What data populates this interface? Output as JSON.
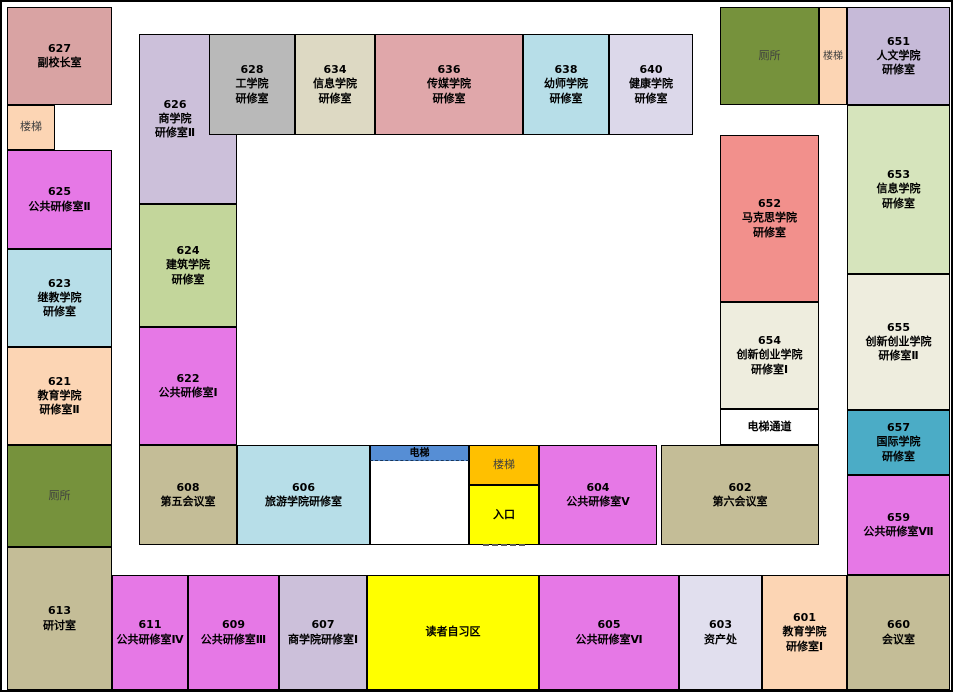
{
  "canvas": {
    "width": 953,
    "height": 692,
    "background": "#ffffff",
    "border_color": "#000000"
  },
  "plan": {
    "rooms": [
      {
        "name": "room-627",
        "lines": [
          "627",
          "副校长室"
        ],
        "bg": "#d9a3a3",
        "x": 5,
        "y": 5,
        "w": 105,
        "h": 98
      },
      {
        "name": "stairs-top-left",
        "lines": [
          "楼梯"
        ],
        "bg": "#fcd5b4",
        "x": 5,
        "y": 103,
        "w": 48,
        "h": 45,
        "muted": true
      },
      {
        "name": "room-625",
        "lines": [
          "625",
          "公共研修室Ⅱ"
        ],
        "bg": "#e678e6",
        "x": 5,
        "y": 148,
        "w": 105,
        "h": 99
      },
      {
        "name": "room-623",
        "lines": [
          "623",
          "继教学院",
          "研修室"
        ],
        "bg": "#b7dee8",
        "x": 5,
        "y": 247,
        "w": 105,
        "h": 98
      },
      {
        "name": "room-621",
        "lines": [
          "621",
          "教育学院",
          "研修室Ⅱ"
        ],
        "bg": "#fcd5b4",
        "x": 5,
        "y": 345,
        "w": 105,
        "h": 98
      },
      {
        "name": "toilet-left",
        "lines": [
          "厕所"
        ],
        "bg": "#76923c",
        "x": 5,
        "y": 443,
        "w": 105,
        "h": 102,
        "muted": true
      },
      {
        "name": "room-613",
        "lines": [
          "613",
          "研讨室"
        ],
        "bg": "#c4bd97",
        "x": 5,
        "y": 545,
        "w": 105,
        "h": 143
      },
      {
        "name": "room-611",
        "lines": [
          "611",
          "公共研修室Ⅳ"
        ],
        "bg": "#e678e6",
        "x": 110,
        "y": 573,
        "w": 76,
        "h": 115
      },
      {
        "name": "room-609",
        "lines": [
          "609",
          "公共研修室Ⅲ"
        ],
        "bg": "#e678e6",
        "x": 186,
        "y": 573,
        "w": 91,
        "h": 115
      },
      {
        "name": "room-607",
        "lines": [
          "607",
          "商学院研修室Ⅰ"
        ],
        "bg": "#ccc0da",
        "x": 277,
        "y": 573,
        "w": 88,
        "h": 115
      },
      {
        "name": "reading-area",
        "lines": [
          "读者自习区"
        ],
        "bg": "#ffff00",
        "x": 365,
        "y": 573,
        "w": 172,
        "h": 115
      },
      {
        "name": "room-605",
        "lines": [
          "605",
          "公共研修室Ⅵ"
        ],
        "bg": "#e678e6",
        "x": 537,
        "y": 573,
        "w": 140,
        "h": 115
      },
      {
        "name": "room-603",
        "lines": [
          "603",
          "资产处"
        ],
        "bg": "#e1dfee",
        "x": 677,
        "y": 573,
        "w": 83,
        "h": 115
      },
      {
        "name": "room-601",
        "lines": [
          "601",
          "教育学院",
          "研修室Ⅰ"
        ],
        "bg": "#fcd5b4",
        "x": 760,
        "y": 573,
        "w": 85,
        "h": 115
      },
      {
        "name": "room-660",
        "lines": [
          "660",
          "会议室"
        ],
        "bg": "#c4bd97",
        "x": 845,
        "y": 573,
        "w": 103,
        "h": 115
      },
      {
        "name": "toilet-top-right",
        "lines": [
          "厕所"
        ],
        "bg": "#76923c",
        "x": 718,
        "y": 5,
        "w": 99,
        "h": 98,
        "muted": true
      },
      {
        "name": "stairs-top-right",
        "lines": [
          "楼梯"
        ],
        "bg": "#fcd5b4",
        "x": 817,
        "y": 5,
        "w": 28,
        "h": 98,
        "muted": true,
        "font": 10
      },
      {
        "name": "room-651",
        "lines": [
          "651",
          "人文学院",
          "研修室"
        ],
        "bg": "#c6bad8",
        "x": 845,
        "y": 5,
        "w": 103,
        "h": 98
      },
      {
        "name": "room-653",
        "lines": [
          "653",
          "信息学院",
          "研修室"
        ],
        "bg": "#d6e4bc",
        "x": 845,
        "y": 103,
        "w": 103,
        "h": 169
      },
      {
        "name": "room-655",
        "lines": [
          "655",
          "创新创业学院",
          "研修室Ⅱ"
        ],
        "bg": "#eeedde",
        "x": 845,
        "y": 272,
        "w": 103,
        "h": 136
      },
      {
        "name": "room-657",
        "lines": [
          "657",
          "国际学院",
          "研修室"
        ],
        "bg": "#4bacc6",
        "x": 845,
        "y": 408,
        "w": 103,
        "h": 65
      },
      {
        "name": "room-659",
        "lines": [
          "659",
          "公共研修室Ⅶ"
        ],
        "bg": "#e678e6",
        "x": 845,
        "y": 473,
        "w": 103,
        "h": 100
      },
      {
        "name": "room-652",
        "lines": [
          "652",
          "马克思学院",
          "研修室"
        ],
        "bg": "#f2908c",
        "x": 718,
        "y": 133,
        "w": 99,
        "h": 167
      },
      {
        "name": "room-654",
        "lines": [
          "654",
          "创新创业学院",
          "研修室Ⅰ"
        ],
        "bg": "#eeedde",
        "x": 718,
        "y": 300,
        "w": 99,
        "h": 107
      },
      {
        "name": "elevator-passage",
        "lines": [
          "电梯通道"
        ],
        "bg": "#ffffff",
        "x": 718,
        "y": 407,
        "w": 99,
        "h": 36
      },
      {
        "name": "room-626",
        "lines": [
          "626",
          "商学院",
          "研修室Ⅱ"
        ],
        "bg": "#ccc0da",
        "x": 137,
        "y": 32,
        "w": 98,
        "h": 170,
        "label_w": 70
      },
      {
        "name": "room-628",
        "lines": [
          "628",
          "工学院",
          "研修室"
        ],
        "bg": "#b9b9b9",
        "x": 207,
        "y": 32,
        "w": 86,
        "h": 101
      },
      {
        "name": "room-634",
        "lines": [
          "634",
          "信息学院",
          "研修室"
        ],
        "bg": "#ddd9c3",
        "x": 293,
        "y": 32,
        "w": 80,
        "h": 101
      },
      {
        "name": "room-636",
        "lines": [
          "636",
          "传媒学院",
          "研修室"
        ],
        "bg": "#e0a7aa",
        "x": 373,
        "y": 32,
        "w": 148,
        "h": 101
      },
      {
        "name": "room-638",
        "lines": [
          "638",
          "幼师学院",
          "研修室"
        ],
        "bg": "#b7dee8",
        "x": 521,
        "y": 32,
        "w": 86,
        "h": 101
      },
      {
        "name": "room-640",
        "lines": [
          "640",
          "健康学院",
          "研修室"
        ],
        "bg": "#dcd8ea",
        "x": 607,
        "y": 32,
        "w": 84,
        "h": 101
      },
      {
        "name": "room-624",
        "lines": [
          "624",
          "建筑学院",
          "研修室"
        ],
        "bg": "#c3d69b",
        "x": 137,
        "y": 202,
        "w": 98,
        "h": 123
      },
      {
        "name": "room-622",
        "lines": [
          "622",
          "公共研修室Ⅰ"
        ],
        "bg": "#e678e6",
        "x": 137,
        "y": 325,
        "w": 98,
        "h": 118
      },
      {
        "name": "room-608",
        "lines": [
          "608",
          "第五会议室"
        ],
        "bg": "#c4bd97",
        "x": 137,
        "y": 443,
        "w": 98,
        "h": 100
      },
      {
        "name": "room-606",
        "lines": [
          "606",
          "旅游学院研修室"
        ],
        "bg": "#b7dee8",
        "x": 235,
        "y": 443,
        "w": 133,
        "h": 100
      },
      {
        "name": "elevator-shaft",
        "lines": [
          "电梯"
        ],
        "bg": "#ffffff",
        "x": 368,
        "y": 443,
        "w": 99,
        "h": 100,
        "type": "elevator",
        "bar_bg": "#568ed5"
      },
      {
        "name": "stairs-bottom",
        "lines": [
          "楼梯"
        ],
        "bg": "#ffc000",
        "x": 467,
        "y": 443,
        "w": 70,
        "h": 40,
        "muted": true
      },
      {
        "name": "entrance",
        "lines": [
          "入口"
        ],
        "bg": "#ffff00",
        "x": 467,
        "y": 483,
        "w": 70,
        "h": 60,
        "dash": true
      },
      {
        "name": "room-604",
        "lines": [
          "604",
          "公共研修室Ⅴ"
        ],
        "bg": "#e678e6",
        "x": 537,
        "y": 443,
        "w": 118,
        "h": 100
      },
      {
        "name": "room-602",
        "lines": [
          "602",
          "第六会议室"
        ],
        "bg": "#c4bd97",
        "x": 659,
        "y": 443,
        "w": 158,
        "h": 100
      }
    ]
  }
}
